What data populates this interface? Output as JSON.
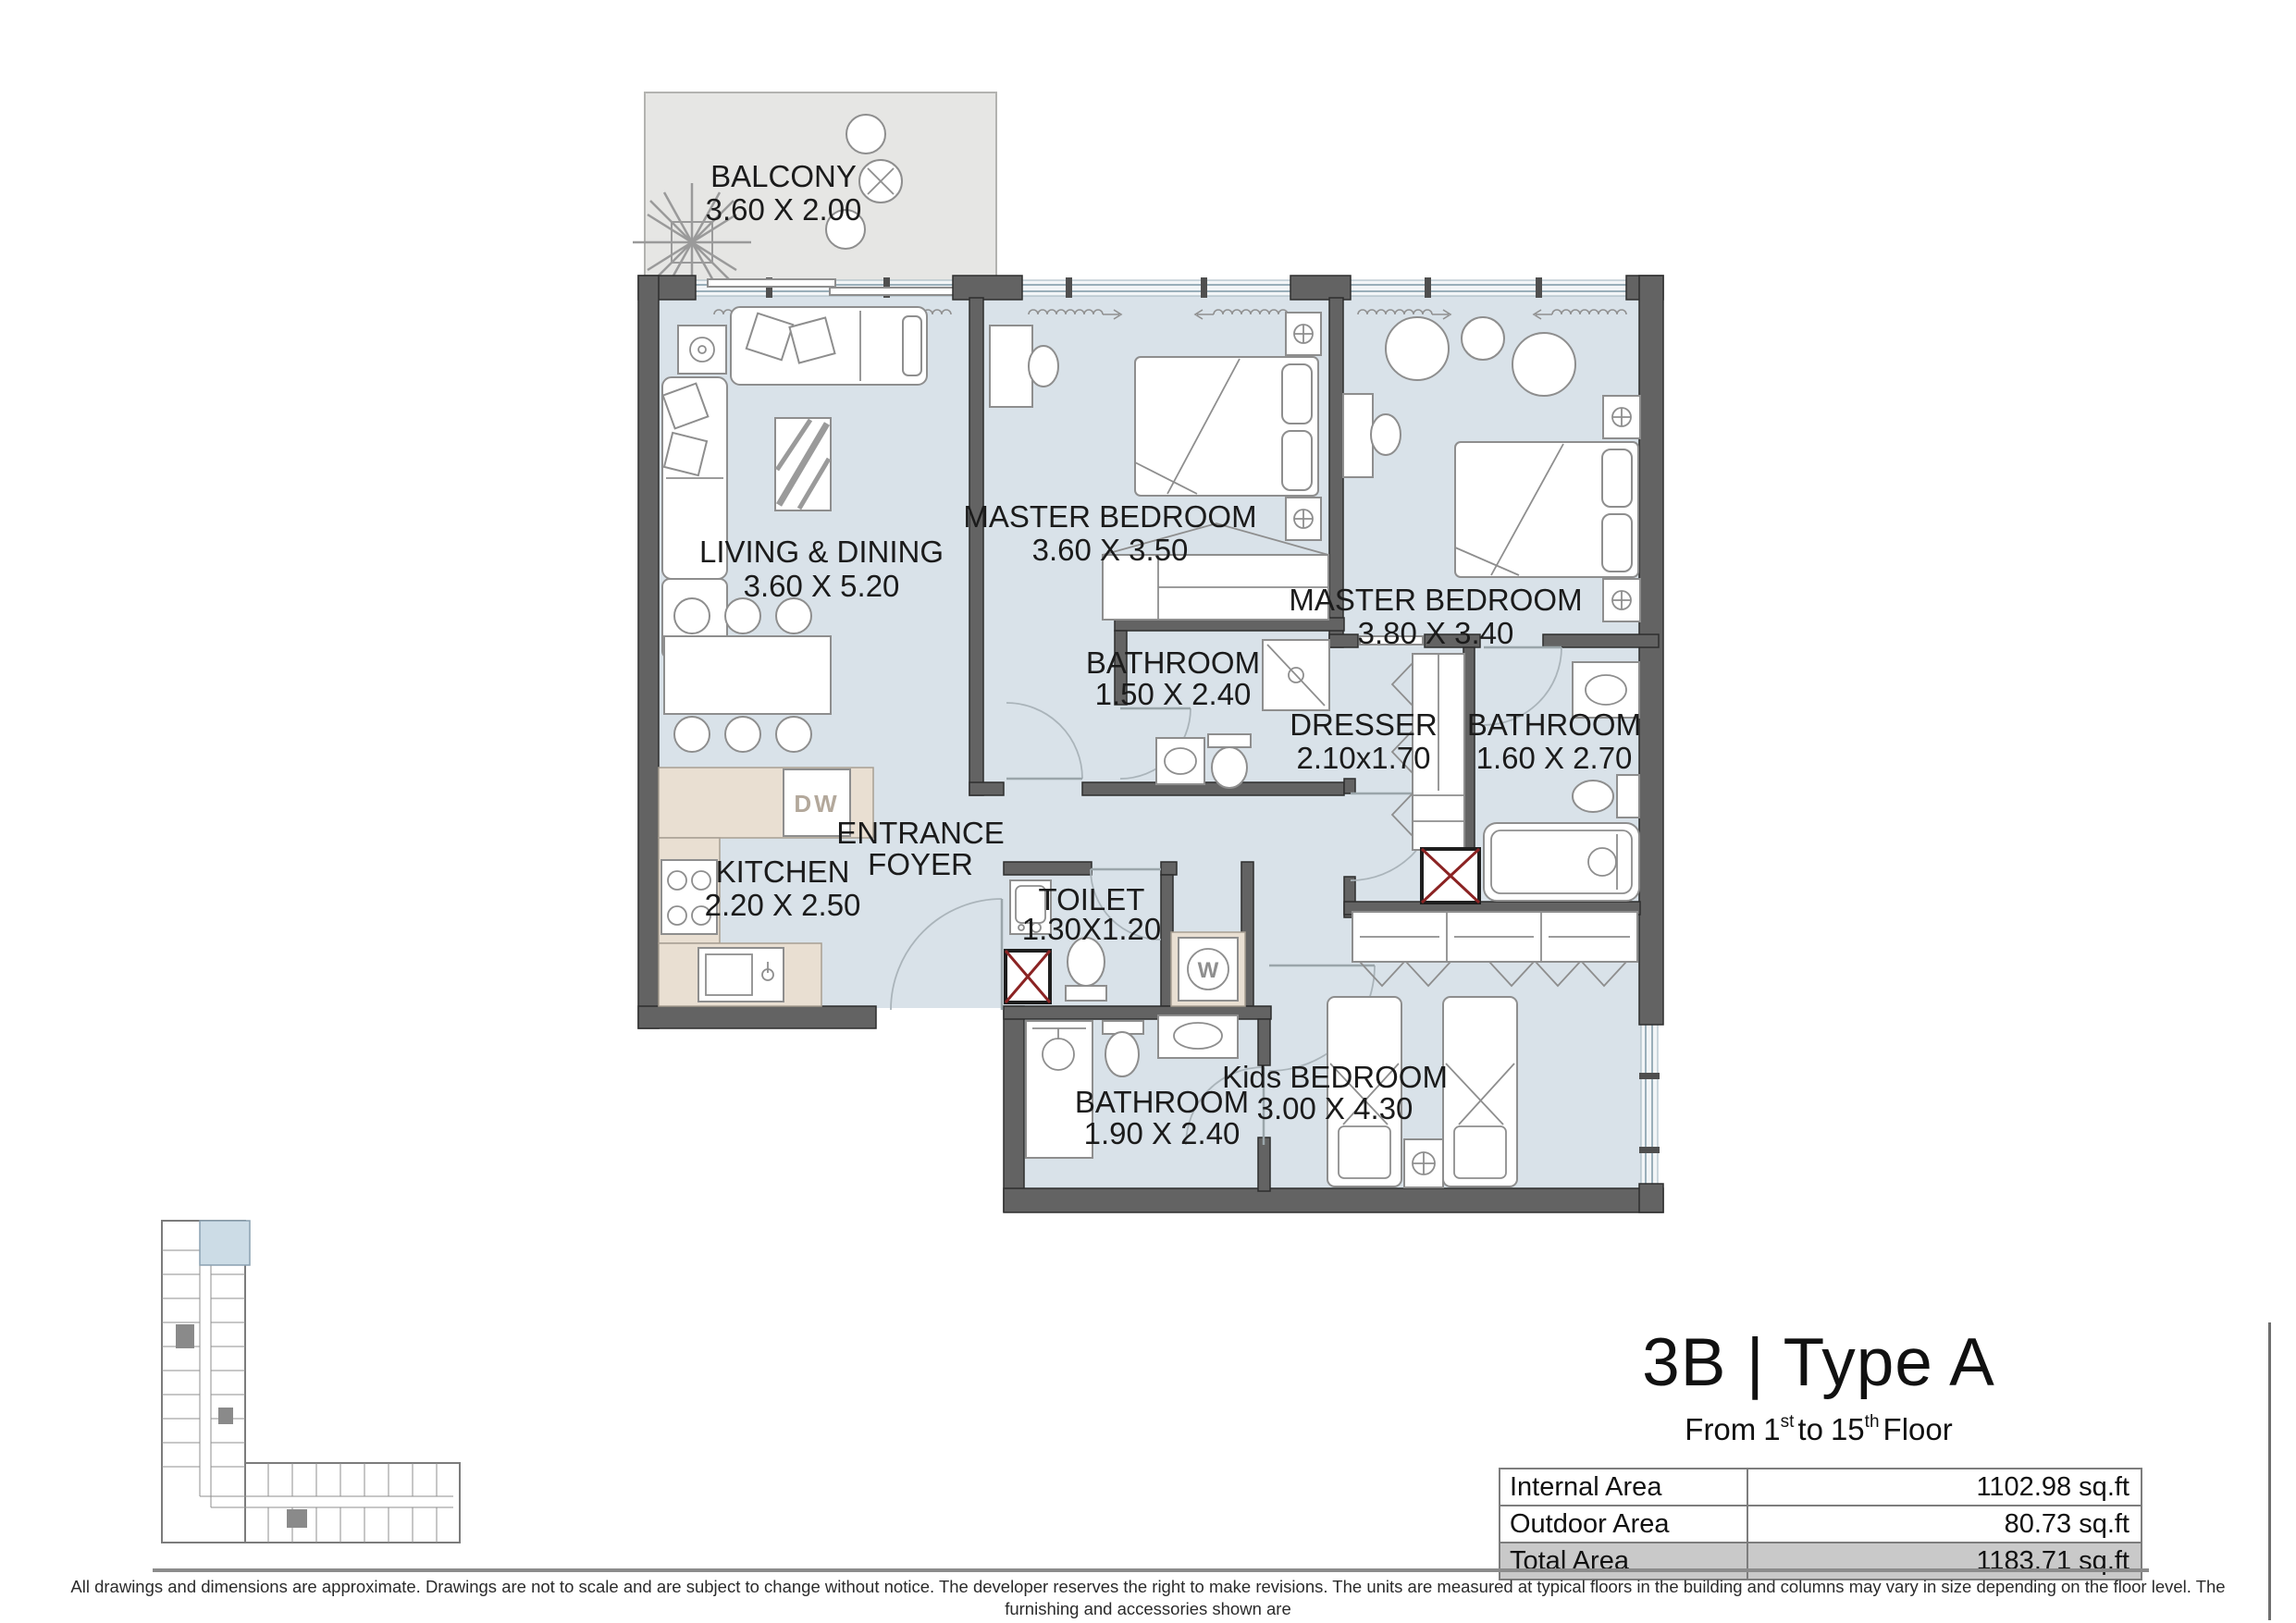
{
  "plan": {
    "balcony": {
      "name": "BALCONY",
      "dims": "3.60 X 2.00"
    },
    "living": {
      "name": "LIVING & DINING",
      "dims": "3.60 X 5.20"
    },
    "master1": {
      "name": "MASTER BEDROOM",
      "dims": "3.60 X 3.50"
    },
    "bath1": {
      "name": "BATHROOM",
      "dims": "1.50 X 2.40"
    },
    "master2": {
      "name": "MASTER BEDROOM",
      "dims": "3.80 X 3.40"
    },
    "dresser": {
      "name": "DRESSER",
      "dims": "2.10x1.70"
    },
    "bath2": {
      "name": "BATHROOM",
      "dims": "1.60 X 2.70"
    },
    "kitchen": {
      "name": "KITCHEN",
      "dims": "2.20 X 2.50"
    },
    "foyer": {
      "line1": "ENTRANCE",
      "line2": "FOYER"
    },
    "toilet": {
      "name": "TOILET",
      "dims": "1.30X1.20"
    },
    "bath3": {
      "name": "BATHROOM",
      "dims": "1.90 X 2.40"
    },
    "kids": {
      "name": "Kids BEDROOM",
      "dims": "3.00 X 4.30"
    },
    "appliances": {
      "dishwasher": "DW",
      "washer": "W"
    }
  },
  "title_block": {
    "title": "3B | Type A",
    "subtitle": {
      "from": "From",
      "n1": "1",
      "s1": "st",
      "to": "to",
      "n2": "15",
      "s2": "th",
      "floor": "Floor"
    },
    "area_table": {
      "rows": [
        {
          "label": "Internal Area",
          "value": "1102.98 sq.ft"
        },
        {
          "label": "Outdoor Area",
          "value": "80.73 sq.ft"
        },
        {
          "label": "Total Area",
          "value": "1183.71 sq.ft"
        }
      ]
    }
  },
  "disclaimer": {
    "line1": "All drawings and dimensions are approximate. Drawings are not to scale and are subject to change without notice. The developer reserves the right to make revisions. The units are measured at typical floors in the building and columns may vary in size depending on the floor level. The furnishing and accessories shown are",
    "line2": "for representation only. The availability, length and width of the balcony varies depending on which floor and which orientation the unit is located within the building. There will be slight differences in the internal areas between the same unit types depending on the shaft sizes that go through the units."
  },
  "colors": {
    "room_fill": "#d9e2e9",
    "balcony_fill": "#e6e6e4",
    "wall": "#636363",
    "shaft_red": "#8b2323",
    "counter": "#e9dfd2",
    "highlight_unit": "#ccdce6",
    "total_row_bg": "#c9c9c9"
  }
}
